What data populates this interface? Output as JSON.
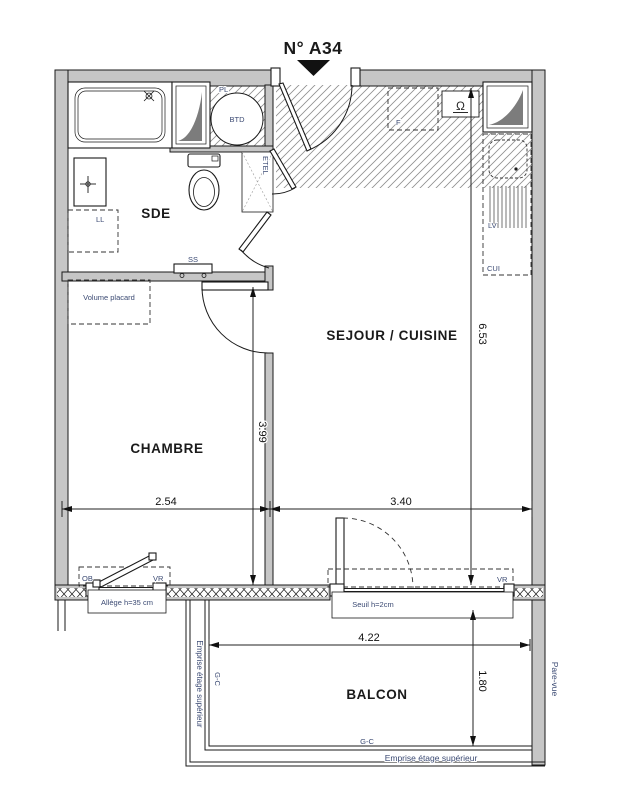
{
  "title": "N° A34",
  "rooms": {
    "sde": "SDE",
    "chambre": "CHAMBRE",
    "sejour": "SEJOUR / CUISINE",
    "balcon": "BALCON"
  },
  "dimensions": {
    "chambre_width": "2.54",
    "sejour_width": "3.40",
    "chambre_depth": "3.99",
    "sejour_depth": "6.53",
    "balcon_width": "4.22",
    "balcon_depth": "1.80"
  },
  "labels": {
    "pl": "PL",
    "btd": "BTD",
    "ll": "LL",
    "ss": "SS",
    "etel": "ETEL",
    "volume_placard": "Volume placard",
    "fridge": "F",
    "lv": "LV",
    "cui": "CUI",
    "ob": "OB",
    "vr_window": "VR",
    "vr_door": "VR",
    "allege": "Allège h=35 cm",
    "seuil": "Seuil h=2cm",
    "tech_symbol": "Ω"
  },
  "balcony": {
    "gc_left": "G-C",
    "gc_bottom": "G-C",
    "emprise_left": "Emprise étage supérieur",
    "emprise_bottom": "Emprise étage supérieur",
    "pare_vue": "Pare-vue"
  },
  "colors": {
    "wall": "#c6c6c6",
    "label_blue": "#3b4a73",
    "ink": "#1a1a1a"
  }
}
